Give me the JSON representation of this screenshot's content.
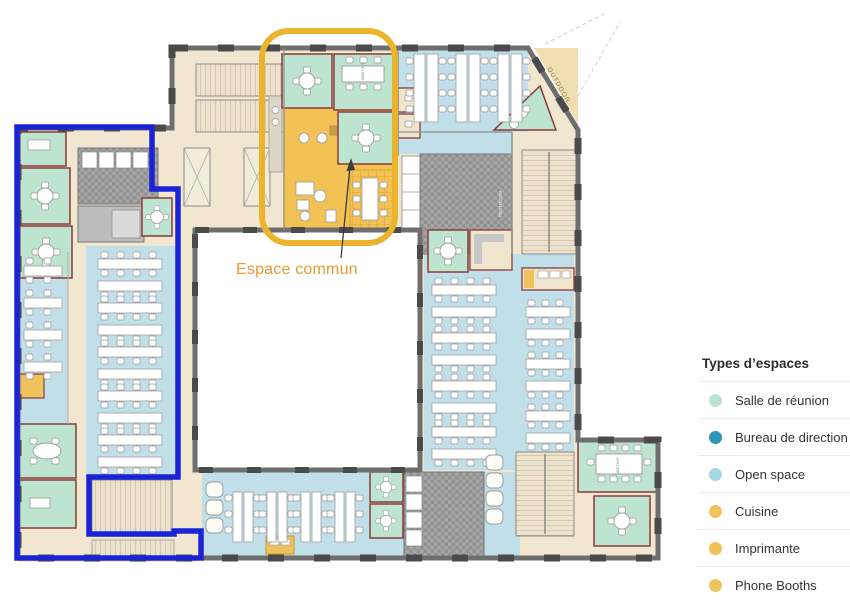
{
  "plan": {
    "espace_commun_label": "Espace commun",
    "outdoor_label": "OUTDOOR",
    "room_labels": {
      "meeting": "MEETING",
      "restroom": "RESTROOM"
    },
    "colors": {
      "zone_outline_blue": "#1a24d6",
      "common_outline_yellow": "#ecb42d",
      "common_label_text": "#e8992f",
      "open_space_fill": "#c0dfe9",
      "meeting_room_fill": "#bce4cf",
      "meeting_wall_red": "#8b3a3a",
      "common_area_fill": "#f2c255",
      "floor_tan": "#f1e7d1",
      "wall_gray": "#6e6e6e"
    }
  },
  "legend": {
    "title": "Types d’espaces",
    "items": [
      {
        "label": "Salle de réunion",
        "color": "#b9e3cf"
      },
      {
        "label": "Bureau de direction",
        "color": "#2e94b8"
      },
      {
        "label": "Open space",
        "color": "#a6d9e4"
      },
      {
        "label": "Cuisine",
        "color": "#eec35c"
      },
      {
        "label": "Imprimante",
        "color": "#eec155"
      },
      {
        "label": "Phone Booths",
        "color": "#eec45f"
      }
    ]
  }
}
